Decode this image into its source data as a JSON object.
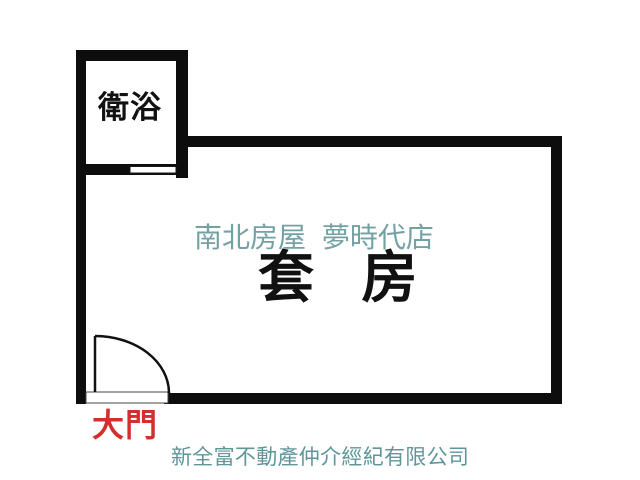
{
  "floorplan": {
    "room_label": "套 房",
    "bathroom_label": "衛浴",
    "door_label": "大門",
    "watermark_text": "南北房屋 夢時代店",
    "company_text": "新全富不動產仲介經紀有限公司",
    "colors": {
      "wall": "#0d0d0d",
      "room_label": "#111111",
      "bathroom_label": "#111111",
      "door_label": "#d32f2f",
      "watermark": "#74a2a4",
      "company": "#5f9698",
      "background": "#ffffff"
    }
  }
}
